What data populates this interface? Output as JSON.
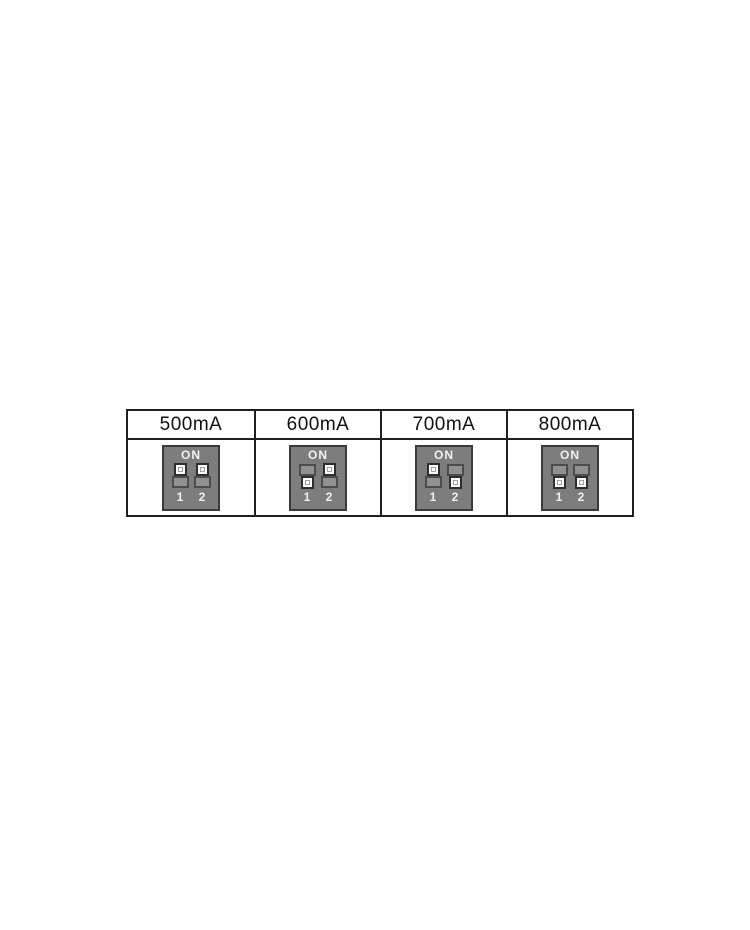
{
  "table": {
    "columns": [
      {
        "label": "500mA",
        "switches": [
          {
            "num": "1",
            "state": "on"
          },
          {
            "num": "2",
            "state": "on"
          }
        ]
      },
      {
        "label": "600mA",
        "switches": [
          {
            "num": "1",
            "state": "off"
          },
          {
            "num": "2",
            "state": "on"
          }
        ]
      },
      {
        "label": "700mA",
        "switches": [
          {
            "num": "1",
            "state": "on"
          },
          {
            "num": "2",
            "state": "off"
          }
        ]
      },
      {
        "label": "800mA",
        "switches": [
          {
            "num": "1",
            "state": "off"
          },
          {
            "num": "2",
            "state": "off"
          }
        ]
      }
    ]
  },
  "dip": {
    "on_label": "ON"
  },
  "colors": {
    "page_bg": "#ffffff",
    "table_border": "#1f1f1f",
    "header_text": "#111111",
    "dip_body": "#7d7d7d",
    "dip_border": "#3a3a3a",
    "dip_slot": "#919191",
    "dip_slot_border": "#4c4c4c",
    "knob_face": "#fcfcfc",
    "knob_border": "#2e2e2e",
    "knob_dot_border": "#a0a0a0",
    "dip_text": "#f2f2f2"
  }
}
